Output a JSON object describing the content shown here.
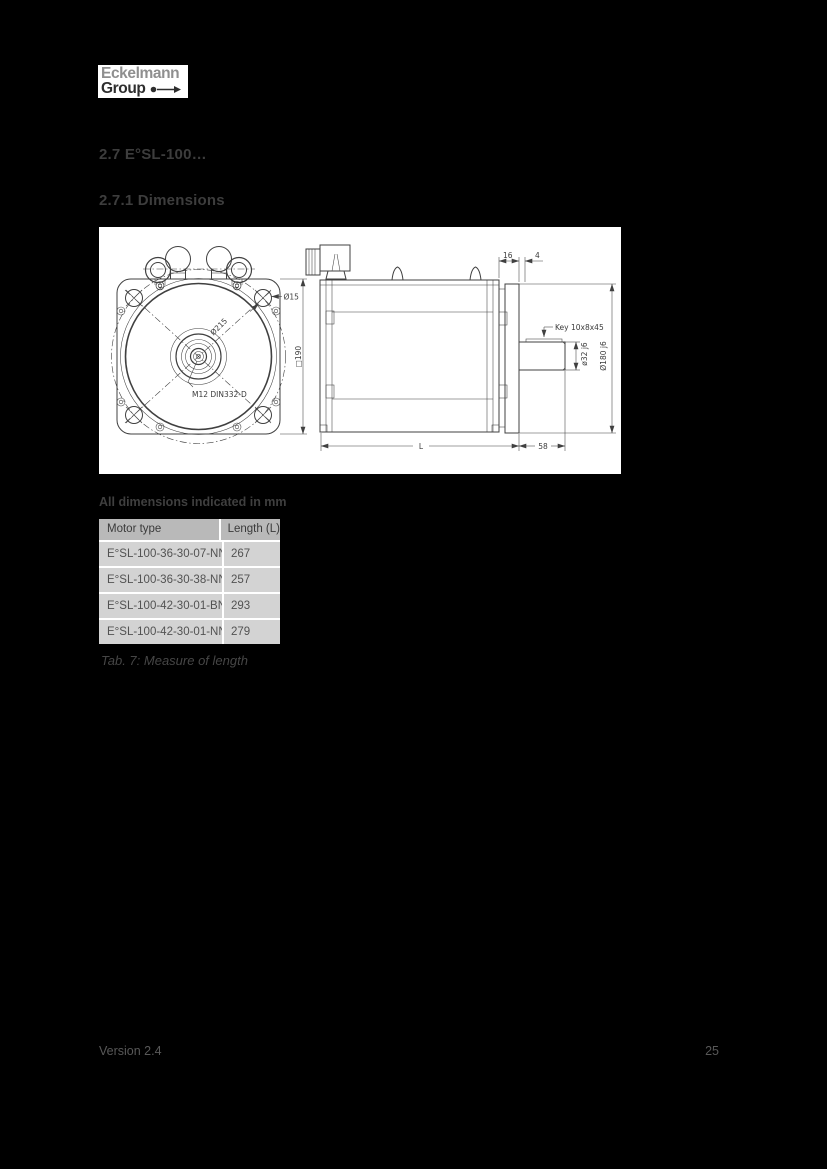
{
  "logo": {
    "line1": "Eckelmann",
    "line2": "Group"
  },
  "headings": {
    "section": "2.7 E°SL-100…",
    "subsection": "2.7.1 Dimensions"
  },
  "drawing": {
    "labels": {
      "dia15": "Ø15",
      "dia215": "Ø215",
      "square190": "□190",
      "m12": "M12 DIN332-D",
      "dim16": "16",
      "dim4": "4",
      "key": "Key 10x8x45",
      "dia32": "ø32 j6",
      "dia180": "Ø180 j6",
      "length": "L",
      "dim58": "58"
    }
  },
  "note": "All dimensions indicated in mm",
  "table": {
    "headers": [
      "Motor type",
      "Length (L)"
    ],
    "rows": [
      {
        "motor_type": "E°SL-100-36-30-07-NN0",
        "length": "267"
      },
      {
        "motor_type": "E°SL-100-36-30-38-NN3",
        "length": "257"
      },
      {
        "motor_type": "E°SL-100-42-30-01-BN0",
        "length": "293"
      },
      {
        "motor_type": "E°SL-100-42-30-01-NN0",
        "length": "279"
      }
    ]
  },
  "caption": "Tab. 7: Measure of length",
  "footer": {
    "version": "Version 2.4",
    "page_number": "25"
  },
  "colors": {
    "page_bg": "#000000",
    "drawing_bg": "#ffffff",
    "table_header_bg": "#b9b9b9",
    "table_row_bg": "#d3d3d3",
    "text": "#3d3d3d"
  }
}
